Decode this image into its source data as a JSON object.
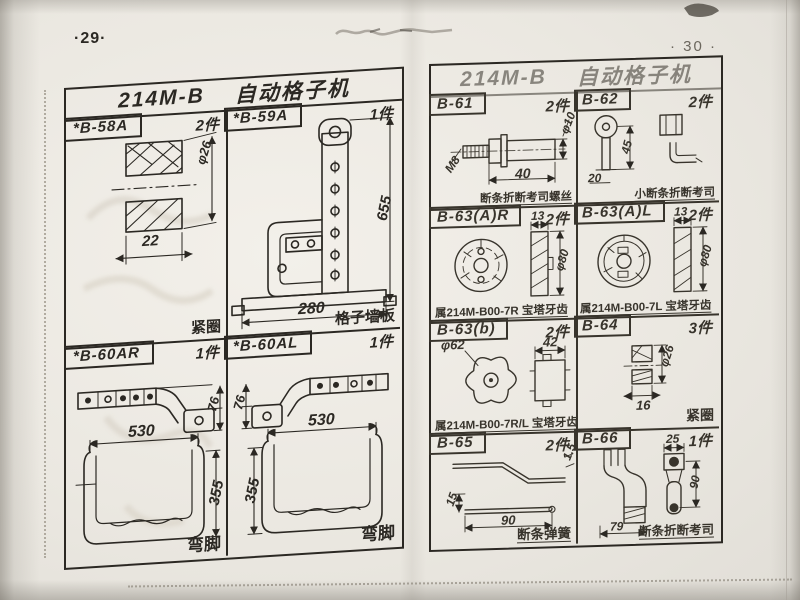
{
  "photo": {
    "left_page_no": "·29·",
    "right_page_no": "· 30 ·"
  },
  "colors": {
    "paper": "#ece9e2",
    "ink": "#2b2823",
    "ink_faded": "#6b665d"
  },
  "left_page": {
    "title_code": "214M-B",
    "title_name": "自动格子机",
    "cells": [
      {
        "code": "*B-58A",
        "qty": "2件",
        "caption": "紧圈",
        "dims": {
          "d1": "φ26",
          "d2": "22"
        }
      },
      {
        "code": "*B-59A",
        "qty": "1件",
        "caption": "格子墙板",
        "dims": {
          "d1": "655",
          "d2": "280"
        }
      },
      {
        "code": "*B-60AR",
        "qty": "1件",
        "caption": "弯脚",
        "dims": {
          "d1": "76",
          "d2": "530",
          "d3": "355"
        }
      },
      {
        "code": "*B-60AL",
        "qty": "1件",
        "caption": "弯脚",
        "dims": {
          "d1": "76",
          "d2": "530",
          "d3": "355"
        }
      }
    ]
  },
  "right_page": {
    "title_code": "214M-B",
    "title_name": "自动格子机",
    "cells": [
      {
        "code": "B-61",
        "qty": "2件",
        "caption": "断条折断考司螺丝",
        "dims": {
          "d1": "M8",
          "d2": "φ10",
          "d3": "40"
        }
      },
      {
        "code": "B-62",
        "qty": "2件",
        "caption": "小断条折断考司",
        "dims": {
          "d1": "45",
          "d2": "20"
        }
      },
      {
        "code": "B-63(A)R",
        "qty": "2件",
        "caption": "属214M-B00-7R 宝塔牙齿",
        "dims": {
          "d1": "13",
          "d2": "φ80"
        }
      },
      {
        "code": "B-63(A)L",
        "qty": "2件",
        "caption": "属214M-B00-7L 宝塔牙齿",
        "dims": {
          "d1": "13",
          "d2": "φ80"
        }
      },
      {
        "code": "B-63(b)",
        "qty": "2件",
        "caption": "属214M-B00-7R/L 宝塔牙齿",
        "dims": {
          "d1": "φ62",
          "d2": "42"
        }
      },
      {
        "code": "B-64",
        "qty": "3件",
        "caption": "紧圈",
        "dims": {
          "d1": "φ26",
          "d2": "16"
        }
      },
      {
        "code": "B-65",
        "qty": "2件",
        "caption": "断条弹簧",
        "dims": {
          "d1": "1.5",
          "d2": "15",
          "d3": "90"
        }
      },
      {
        "code": "B-66",
        "qty": "1件",
        "caption": "断条折断考司",
        "dims": {
          "d1": "25",
          "d2": "90",
          "d3": "79"
        }
      }
    ]
  }
}
